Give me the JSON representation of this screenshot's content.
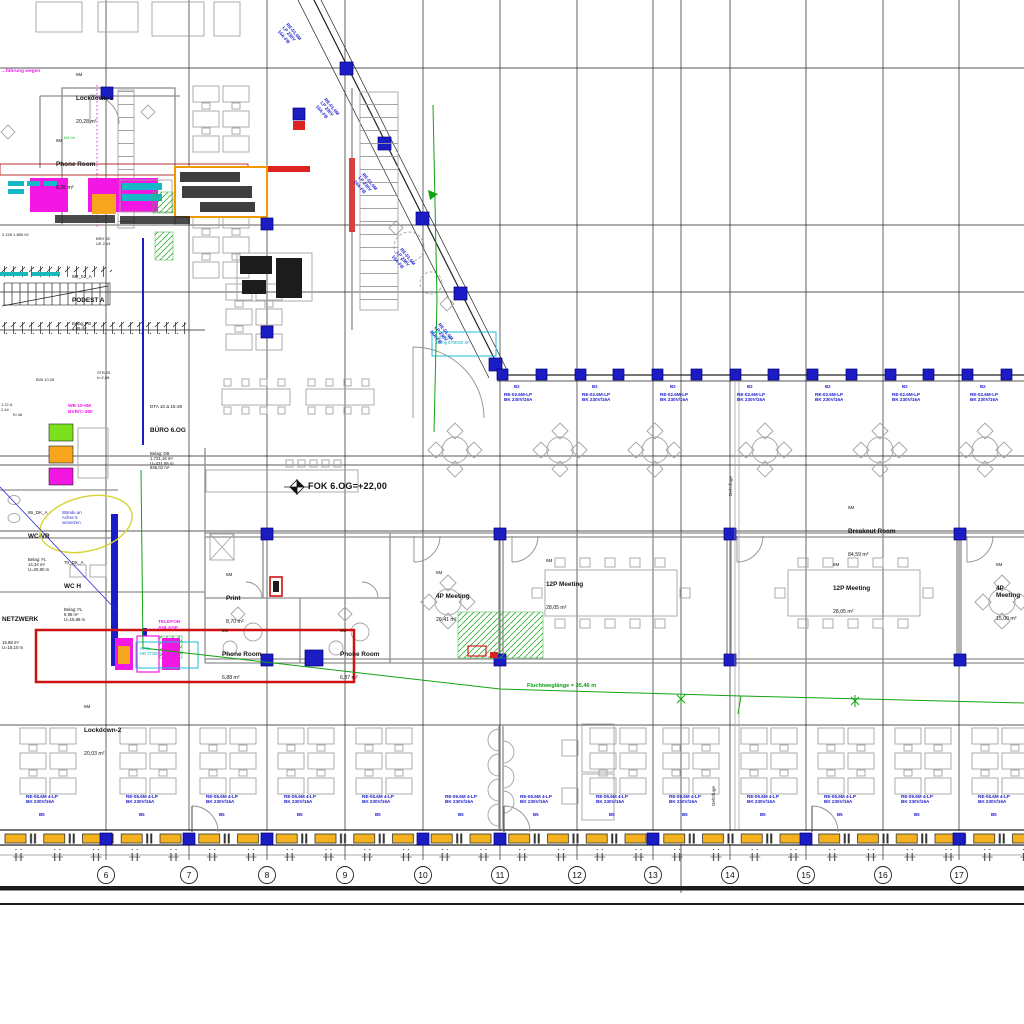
{
  "meta": {
    "title": "Office floor plan 6.OG – CAD drawing"
  },
  "levels": {
    "fok": "FOK 6.OG=+22,00"
  },
  "notes": {
    "escape": "Fluchtweglänge = 35,46 m",
    "magenta_top": "…führung wegen",
    "dehnfuge": "Dehnfuge",
    "cloud": "Wände an\nAchse 5\nversetzen",
    "asta": "ASTA B\nBemg 87/8000 SF",
    "spk": "SPKL\nNR 07/08 B",
    "wd": "WB 10-6M\nBVR/C-380",
    "telefon": "TELEFON\nANLAGE",
    "green_tag": "6M-04"
  },
  "rooms": {
    "lockdown1": {
      "tag": "6M",
      "name": "Lockdown-1",
      "area": "20,28 m²"
    },
    "phonetop": {
      "tag": "6M",
      "name": "Phone Room",
      "area": "6,35 m²"
    },
    "podest": {
      "tag": "6M_02_A",
      "name": "PODEST A",
      "extra": "Belag: PB\n4,85 m²"
    },
    "buero": {
      "tag": "DTA 10 Δ 15-26",
      "name": "BÜRO 6.OG",
      "extra": "Belag: DB\n1.721,16 m²\nU=431,85 m\n846,02 m²"
    },
    "wcvr": {
      "tag": "65_DK_A",
      "name": "WC-VR",
      "extra": "Belag: FL\n14,34 m²\nU=20,80 m"
    },
    "wch": {
      "tag": "70_DK_A",
      "name": "WC H",
      "extra": "Belag: FL\n8,98 m²\nU=15,88 m"
    },
    "netz": {
      "name": "NETZWERK",
      "extra": "19,88 m²\nU=18,10 m"
    },
    "lockdown2": {
      "tag": "6M",
      "name": "Lockdown-2",
      "area": "20,03 m²"
    },
    "print": {
      "tag": "6M",
      "name": "Print",
      "area": "8,70 m²"
    },
    "phonea": {
      "tag": "6M",
      "name": "Phone Room",
      "area": "6,88 m²"
    },
    "phoneb": {
      "tag": "6M",
      "name": "Phone Room",
      "area": "6,87 m²"
    },
    "meet4a": {
      "tag": "6M",
      "name": "4P Meeting",
      "area": "26,41 m²"
    },
    "meet12a": {
      "tag": "6M",
      "name": "12P Meeting",
      "area": "28,05 m²"
    },
    "breakout": {
      "tag": "6M",
      "name": "Breakout Room",
      "area": "84,59 m²"
    },
    "meet12b": {
      "tag": "6M",
      "name": "12P Meeting",
      "area": "28,05 m²"
    },
    "meet4b": {
      "tag": "6M",
      "name": "4P Meeting",
      "area": "15,00 m²"
    }
  },
  "grid": {
    "bubbles": [
      "6",
      "7",
      "8",
      "9",
      "10",
      "11",
      "12",
      "13",
      "14",
      "15",
      "16",
      "17"
    ]
  },
  "blue": {
    "head_band": "B2",
    "band": "RE-02.6M-LP\nBK 230V/16A",
    "diag": "RE-01.6M\nLP 230V\n16A-FB",
    "desk": "RE-05.6M 4-LP\nBK 230V/16A",
    "head_desk": "B5"
  },
  "micro": {
    "m1": "2.155  1.885  92",
    "m2": "BRH 92\nUK 2,44",
    "m3": "B05  10,28",
    "m4": "1.22 A\n2.44",
    "m5": "STB 25\nh=2,58",
    "m6": "Kl 46"
  }
}
